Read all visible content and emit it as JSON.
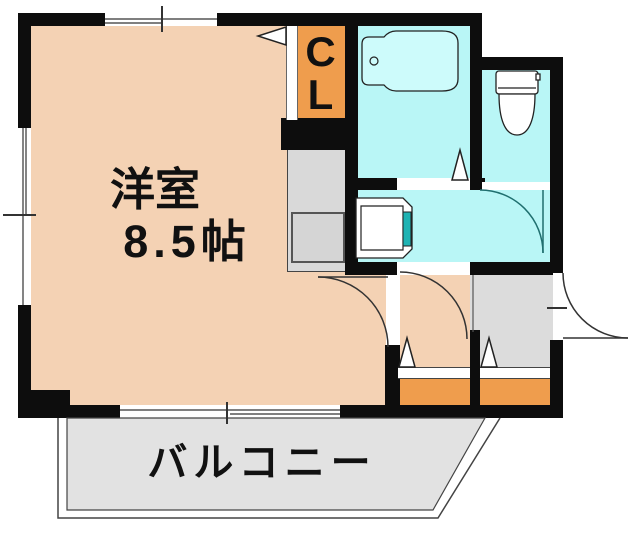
{
  "labels": {
    "main_room_name": "洋室",
    "main_room_size": "8.5帖",
    "closet_line1": "C",
    "closet_line2": "L",
    "balcony": "バルコニー"
  },
  "colors": {
    "wall": "#0d0d0d",
    "room-peach": "#f4d2b4",
    "accent-orange": "#ef9d4d",
    "wet-cyan": "#b9f6f6",
    "tub-cyan": "#cdfbfb",
    "teal-accent": "#1fb3b3",
    "kitchen-gray": "#d9d9d9",
    "entry-gray": "#dcdcdc",
    "balcony-gray": "#e2e2e2",
    "line": "#333333",
    "text": "#111111"
  },
  "legend": {
    "rooms": [
      "western-room",
      "closet",
      "kitchen-counter",
      "bathroom",
      "toilet-room",
      "washroom",
      "hallway",
      "entrance",
      "balcony"
    ],
    "fixtures": [
      "bathtub",
      "toilet-bowl",
      "washing-machine",
      "kitchen-sink"
    ],
    "symbols": [
      "door-swing-arc",
      "step-triangle",
      "window-tick"
    ]
  }
}
